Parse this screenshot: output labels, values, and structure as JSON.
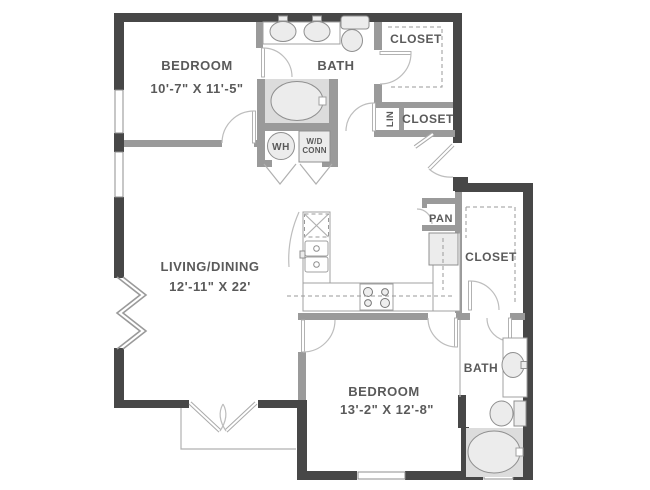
{
  "plan": {
    "rooms": {
      "bedroom1": {
        "name": "BEDROOM",
        "dims": "10'-7\" X 11'-5\""
      },
      "bath1": {
        "name": "BATH"
      },
      "closet_top": {
        "name": "CLOSET"
      },
      "linen": {
        "name": "LIN"
      },
      "closet_hall": {
        "name": "CLOSET"
      },
      "living": {
        "name": "LIVING/DINING",
        "dims": "12'-11\" X 22'"
      },
      "pantry": {
        "name": "PAN"
      },
      "closet_main": {
        "name": "CLOSET"
      },
      "bedroom2": {
        "name": "BEDROOM",
        "dims": "13'-2\" X 12'-8\""
      },
      "bath2": {
        "name": "BATH"
      },
      "utility": {
        "water_heater": "WH",
        "wd_line1": "W/D",
        "wd_line2": "CONN"
      }
    },
    "colors": {
      "wall_exterior": "#474747",
      "wall_interior": "#9a9a9a",
      "fixture_stroke": "#8f8f8f",
      "fixture_fill": "#ececec",
      "tub_cavity": "#dcdcdc",
      "label_text": "#5a5a5a",
      "door_arc": "#bdbdbd",
      "background": "#ffffff"
    }
  }
}
